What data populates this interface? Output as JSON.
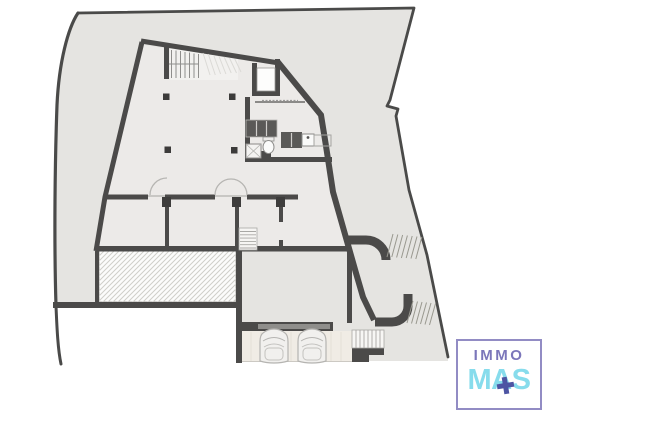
{
  "page": {
    "background_color": "#ffffff"
  },
  "logo": {
    "line1": "IMMO",
    "line2": "MAS",
    "plus_icon": "plus-cross-icon",
    "colors": {
      "border": "#928cc4",
      "immo_text": "#7b76ba",
      "mas_text": "#87dcec",
      "plus": "#4d55a3"
    }
  },
  "floor_plan": {
    "type": "architectural-floor-plan-basement-level",
    "palette": {
      "site_fill": "#e5e4e1",
      "interior_fill": "#eceae8",
      "wall": "#4b4a49",
      "boundary_line": "#4a4a49",
      "garage_floor": "#f0ece5",
      "garage_door": "#8f8e8b",
      "hatch_line": "#cfcec9",
      "fixture_dark": "#5a5957",
      "column": "#3c3b3a"
    },
    "features": [
      "site-boundary",
      "building-walls",
      "main-staircase",
      "upper-flight-faint",
      "elevator-shaft",
      "kitchen-counter",
      "sink",
      "toilet",
      "washer-box",
      "structural-columns",
      "room-partitions",
      "door-swing-arcs",
      "interior-staircase",
      "hatched-terrace",
      "garage",
      "garage-door",
      "car-top-view",
      "car-top-view",
      "garage-side-stairs",
      "curved-wall-north",
      "curved-wall-south",
      "fan-steps-north",
      "fan-steps-south"
    ]
  }
}
